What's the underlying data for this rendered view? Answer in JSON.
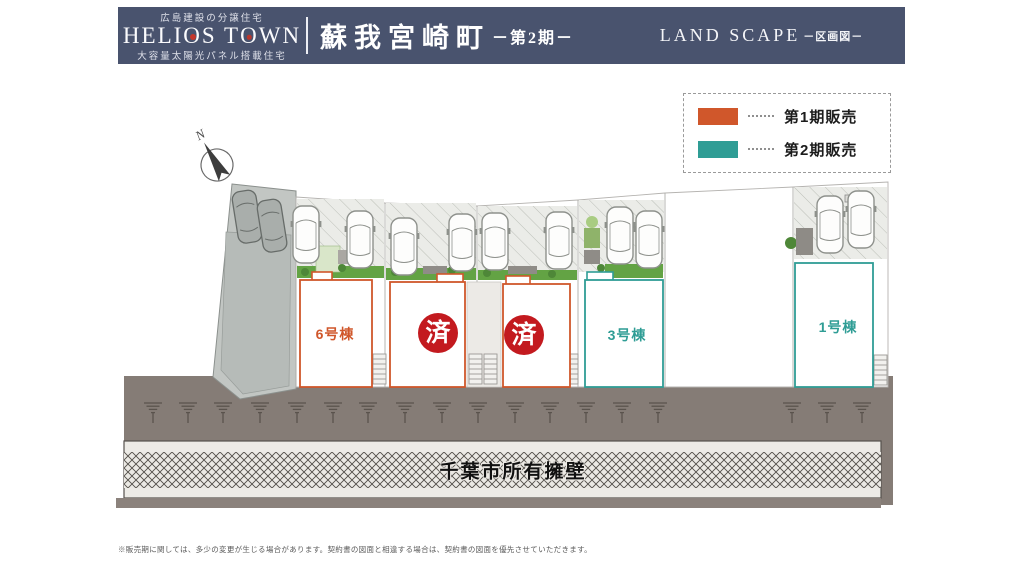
{
  "colors": {
    "banner": "#49536e",
    "phase1": "#d0572b",
    "phase2": "#2f9d95",
    "sold": "#c31a1f",
    "road": "#857c76"
  },
  "header": {
    "tagline_top": "広島建設の分譲住宅",
    "brand_l": "HELI",
    "brand_o1": "O",
    "brand_m": "S T",
    "brand_o2": "O",
    "brand_r": "WN",
    "tagline_bottom": "大容量太陽光パネル搭載住宅",
    "title": "蘇我宮崎町",
    "title_suffix": "－第2期－",
    "subtitle_en": "LAND SCAPE",
    "subtitle_suffix": "－区画図－"
  },
  "legend": {
    "items": [
      {
        "label": "第1期販売"
      },
      {
        "label": "第2期販売"
      }
    ]
  },
  "plan": {
    "north": "N",
    "wall_label": "千葉市所有擁壁",
    "lots": [
      {
        "label": "6号棟",
        "phase": 1
      },
      {
        "label": "済",
        "sold": true
      },
      {
        "label": "済",
        "sold": true
      },
      {
        "label": "3号棟",
        "phase": 2
      },
      {
        "label": "1号棟",
        "phase": 2
      }
    ]
  },
  "footnote": "※販売期に関しては、多少の変更が生じる場合があります。契約書の図面と相違する場合は、契約書の図面を優先させていただきます。"
}
